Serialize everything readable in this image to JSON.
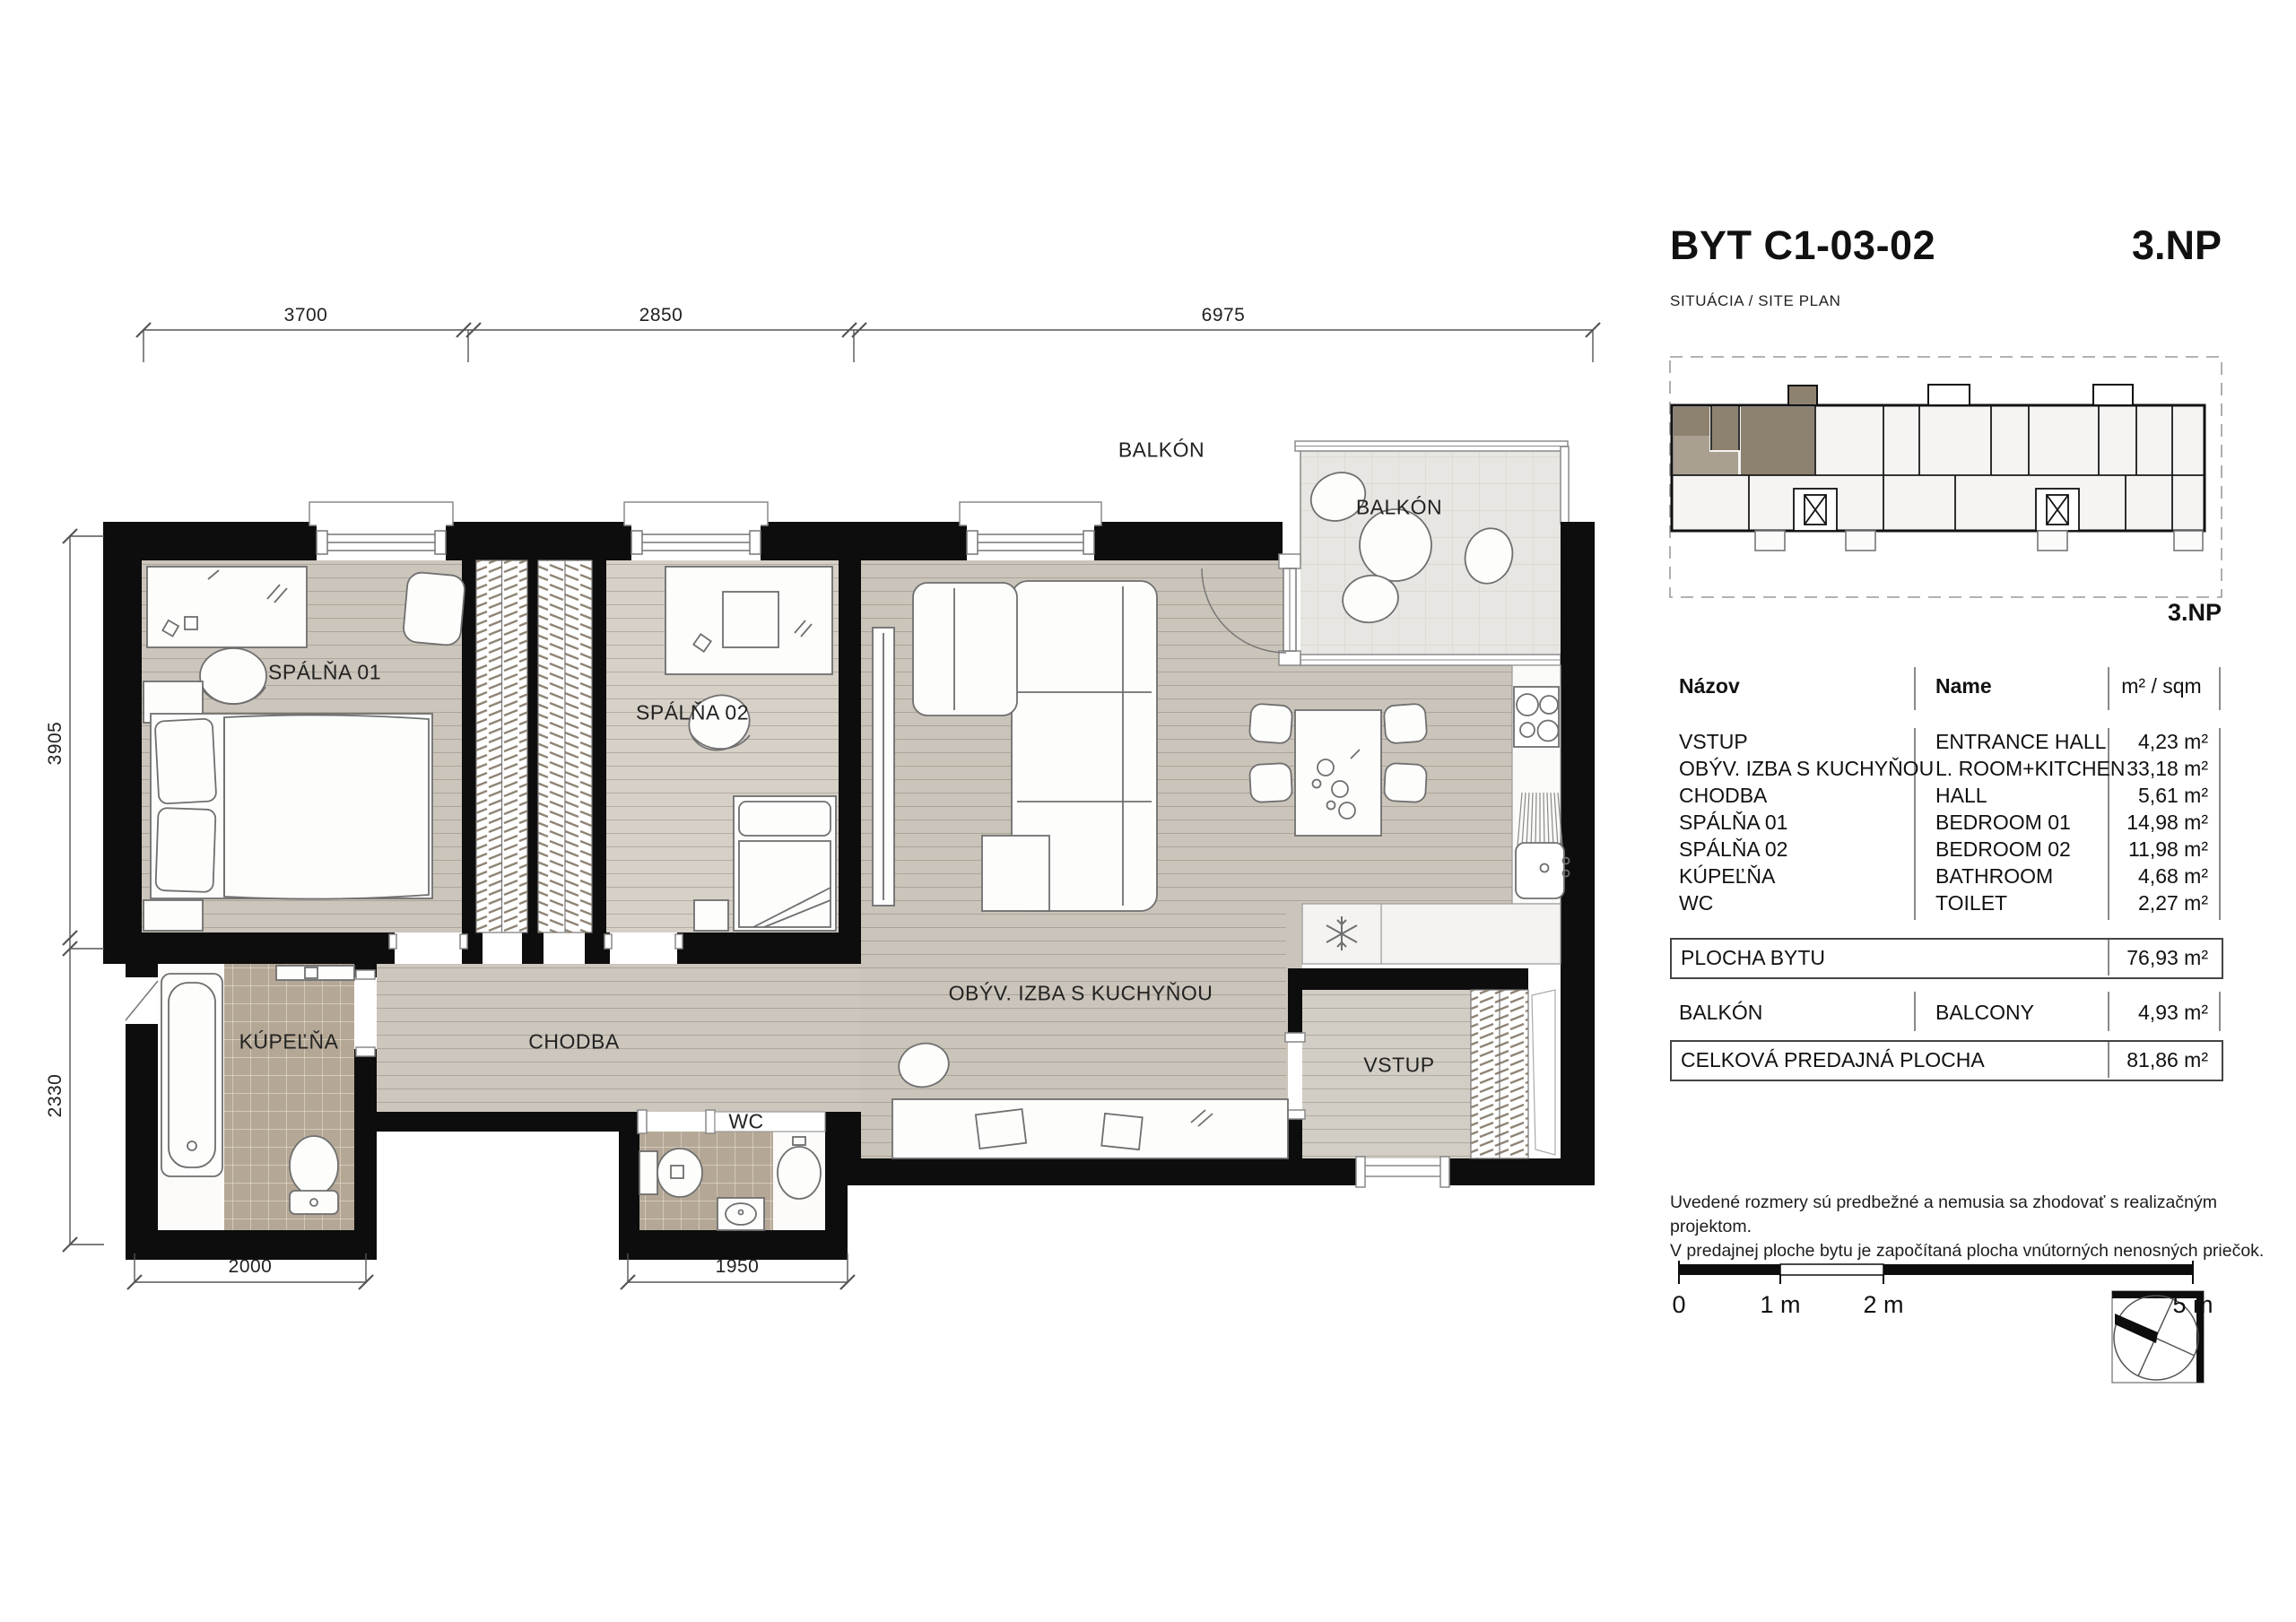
{
  "title": {
    "code": "BYT C1-03-02",
    "floor": "3.NP",
    "subtitle": "SITUÁCIA / SITE PLAN"
  },
  "site_plan": {
    "floor_label": "3.NP"
  },
  "floor_plan": {
    "labels": {
      "bedroom1": "SPÁLŇA 01",
      "bedroom2": "SPÁLŇA 02",
      "living": "OBÝV. IZBA S KUCHYŇOU",
      "hall": "CHODBA",
      "bathroom": "KÚPEĽŇA",
      "wc": "WC",
      "entrance": "VSTUP",
      "balcony": "BALKÓN",
      "balcony_outside": "BALKÓN"
    },
    "dimensions": {
      "top": [
        "3700",
        "2850",
        "6975"
      ],
      "left": [
        "3905",
        "2330"
      ],
      "bottom": [
        "2000",
        "1950"
      ]
    }
  },
  "area_table": {
    "headers": {
      "sk": "Názov",
      "en": "Name",
      "unit": "m² / sqm"
    },
    "rows": [
      {
        "sk": "VSTUP",
        "en": "ENTRANCE HALL",
        "area": "4,23 m²"
      },
      {
        "sk": "OBÝV. IZBA S KUCHYŇOU",
        "en": "L. ROOM+KITCHEN",
        "area": "33,18 m²"
      },
      {
        "sk": "CHODBA",
        "en": "HALL",
        "area": "5,61 m²"
      },
      {
        "sk": "SPÁLŇA 01",
        "en": "BEDROOM 01",
        "area": "14,98 m²"
      },
      {
        "sk": "SPÁLŇA 02",
        "en": "BEDROOM 02",
        "area": "11,98 m²"
      },
      {
        "sk": "KÚPEĽŇA",
        "en": "BATHROOM",
        "area": "4,68 m²"
      },
      {
        "sk": "WC",
        "en": "TOILET",
        "area": "2,27 m²"
      }
    ],
    "apartment_area": {
      "label": "PLOCHA BYTU",
      "value": "76,93 m²"
    },
    "balcony_row": {
      "sk": "BALKÓN",
      "en": "BALCONY",
      "area": "4,93 m²"
    },
    "total": {
      "label": "CELKOVÁ PREDAJNÁ PLOCHA",
      "value": "81,86 m²"
    }
  },
  "notes": {
    "line1": "Uvedené rozmery sú predbežné a nemusia sa zhodovať s realizačným projektom.",
    "line2": "V predajnej ploche bytu je započítaná plocha vnútorných nenosných priečok."
  },
  "scale_bar": {
    "labels": [
      "0",
      "1 m",
      "2 m",
      "5 m"
    ]
  },
  "colors": {
    "wall": "#0d0d0d",
    "floor": "#ccc5bb",
    "floor_light": "#d6d0c7",
    "tile": "#b4a795",
    "balcony_floor": "#e8e6e2",
    "unit_highlight": "#8d8170",
    "unit_highlight_light": "#aaa091"
  }
}
